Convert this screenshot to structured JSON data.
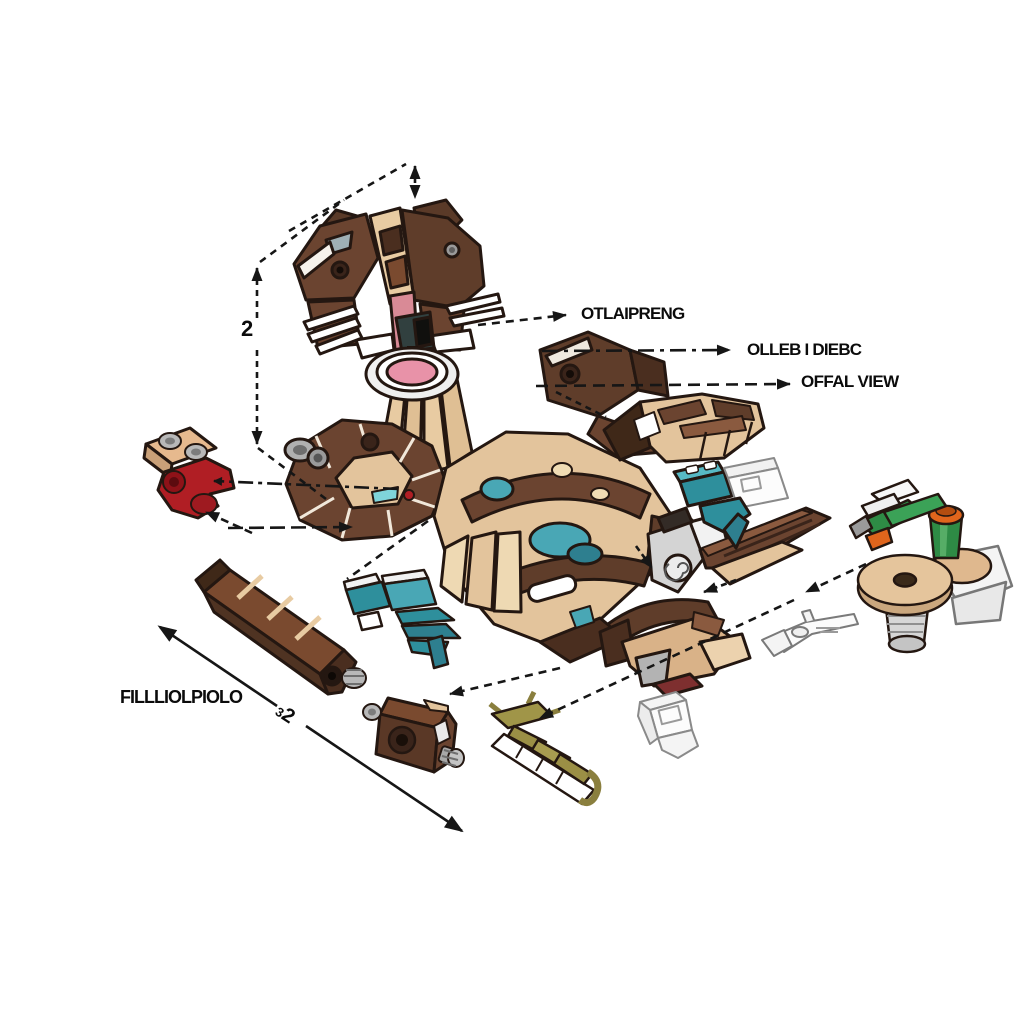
{
  "canvas": {
    "width": 1024,
    "height": 1024,
    "background": "#ffffff"
  },
  "callouts": {
    "label_1": "OTLAIPRENG",
    "label_2": "OLLEB I DIEBC",
    "label_3": "OFFAL VIEW"
  },
  "annotations": {
    "part_label": "FILLLIOLPIOLO",
    "dimension_vertical": "2",
    "dimension_diagonal": "32"
  },
  "palette": {
    "outline": "#241711",
    "ink": "#161616",
    "brown_dark": "#4a2e1f",
    "brown": "#6b4430",
    "brown_mid": "#5f3d2a",
    "brown_light": "#8a5a3f",
    "tan": "#e3c49c",
    "tan_light": "#f0dfc0",
    "teal": "#2e8f9c",
    "teal_light": "#57b9c4",
    "red": "#b01e24",
    "red_dark": "#8e1218",
    "pink": "#e892a8",
    "olive": "#9b8f45",
    "green": "#2e8b45",
    "orange": "#e0651c",
    "gray": "#b0b0b0",
    "gray_dark": "#8f8f8f",
    "white": "#ffffff"
  },
  "parts": [
    {
      "name": "otter-head-assembly"
    },
    {
      "name": "right-shoulder-assembly"
    },
    {
      "name": "left-arm-assembly"
    },
    {
      "name": "torso-assembly"
    },
    {
      "name": "paw-assembly"
    },
    {
      "name": "teal-connector-bricks"
    },
    {
      "name": "tail-assembly"
    },
    {
      "name": "foot-assembly"
    },
    {
      "name": "red-clip-part"
    },
    {
      "name": "teal-claw-part"
    },
    {
      "name": "long-arm-beam"
    },
    {
      "name": "barrel-cylinder-part"
    },
    {
      "name": "twig-sprue-part"
    },
    {
      "name": "ghost-outline-brick"
    },
    {
      "name": "tool-outline-part"
    },
    {
      "name": "accessory-cluster"
    }
  ]
}
